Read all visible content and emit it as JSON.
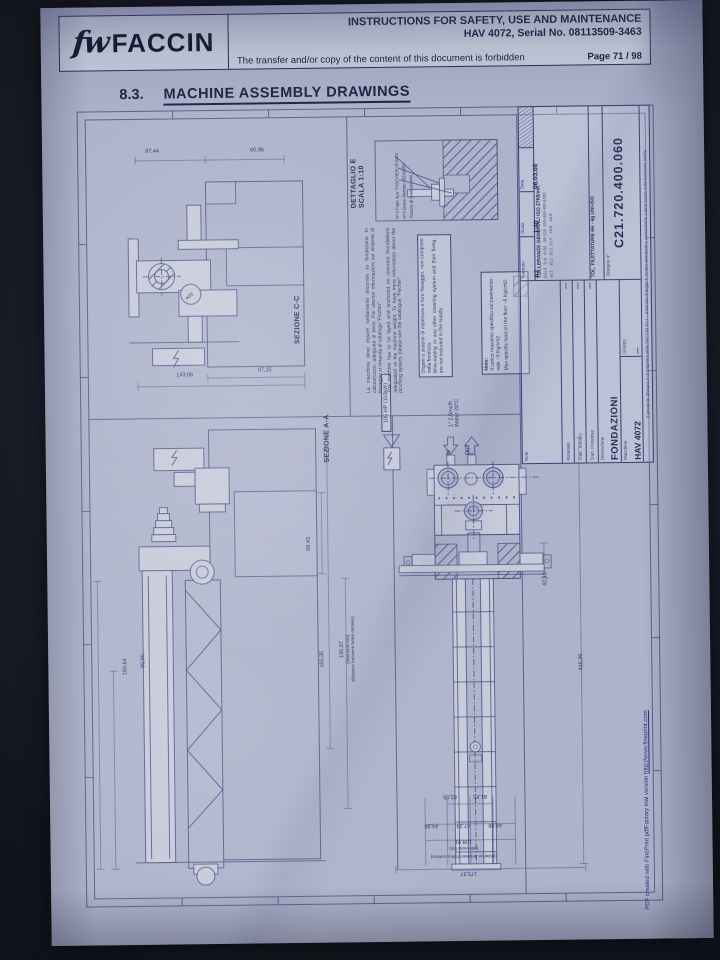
{
  "header": {
    "logo_mark": "fw",
    "logo_text": "FACCIN",
    "line1": "INSTRUCTIONS FOR SAFETY, USE AND MAINTENANCE",
    "line2": "HAV 4072, Serial No. 08113509-3463",
    "line3": "The transfer and/or copy of the content of this document is forbidden",
    "page_label": "Page 71 / 98"
  },
  "section": {
    "number": "8.3.",
    "title": "MACHINE ASSEMBLY DRAWINGS"
  },
  "drawing": {
    "views": {
      "section_cc": "SEZIONE C-C",
      "section_aa": "SEZIONE A-A",
      "detail_label": "DETTAGLIO E",
      "detail_scale": "SCALA 1:10"
    },
    "annotations": {
      "power": "105 HP (110kW)",
      "water_flow": "1\" 2,5mc/h",
      "water_temp": "Water  20°C",
      "in": "IN",
      "out": "OUT"
    },
    "callouts": [
      "N°4 Fiale tipo \"FISCHER\" R M24",
      "N°4 Barre filettate M24x300",
      "Piastra di livellamento"
    ],
    "notes": {
      "note1_it": "La macchina deve essere saldamente ancorata su fondazione in calcestruzzo, adeguata al peso. Per ulteriori informazioni sul sistema di fissaggio si rimanda al catalogo \"Fischer\".",
      "note1_en": "The machine has to be layed and anchored on concrete foundations adeguated vs the machine weight. To have more information about the pinching system, please see the catalogue \"Fischer\".",
      "note2_it": "Organi o sistemi di copertura e loro fissaggio, non compresi nella fornitura.",
      "note2_en": "Wire-netting or any other covering system and their fixing, are not included in the supply.",
      "note3_title": "Note:",
      "note3_it": "Il carico massimo specifico sul pavimento vale ~5 Kg/cm2.",
      "note3_en": "Max specific load on the floor ~5 Kg/cm2."
    },
    "dimensions": {
      "cc_w1": "97,44",
      "cc_w2": "60,96",
      "cc_dia": "ø26",
      "cc_b1": "143,06",
      "cc_b2": "97,25",
      "aa_left1": "169,84",
      "aa_left2": "95,95",
      "aa_right1": "98,43",
      "aa_right2": "165,35",
      "pitch": "195,87",
      "pitch_it": "(Interasse fori)",
      "pitch_en": "(distance between holes centres)",
      "plan_side": "42,13",
      "plan_len": "415,39",
      "plan_r1": "82,05",
      "plan_r2": "81,65",
      "plan_b1": "44,96",
      "plan_b2": "47,24",
      "plan_b3": "44,96",
      "plan_holes": "108,91",
      "plan_total": "173,37"
    },
    "titleblock": {
      "note_label": "Note",
      "materiale_label": "Materiale",
      "materiale": "—",
      "tratt_term_label": "Tratt. Termico",
      "tratt_term": "—",
      "tratt_prot_label": "Tratt. Protettivo",
      "tratt_prot": "—",
      "descrizione_label": "Descrizione",
      "descrizione": "FONDAZIONI",
      "macchina_label": "Macchina",
      "macchina": "HAV 4072",
      "gruppo_label": "Gruppo",
      "gruppo": "—",
      "formato_label": "Formato",
      "formato": "A2",
      "scala_label": "Scala",
      "scala": "1:40",
      "data_label": "Data",
      "data": "06.03.08",
      "tolleranze": "TOLLERANZE GENERALI ISO 2768/mK",
      "tol_row1": "0,5÷3   3÷6   6÷30   30÷120  120÷400 400÷1000",
      "tol_row2": "±0,1    ±0,1  ±0,2  ±0,3    ±0,5    ±0,8",
      "filettature": "TOL. FILETTATURE 6H - 6g  UNI-ISO",
      "disegno_label": "Disegno n°",
      "disegno": "C21.720.400.060",
      "ownership": "Il presente disegno è di proprietà della FACCIN S.r.l. - A termini di legge è vietato riprodurlo o comunicarlo a terzi senza autorizzazione scritta"
    }
  },
  "footer": {
    "text": "PDF created with FinePrint pdfFactory trial version ",
    "url": "http://www.fineprint.com"
  }
}
